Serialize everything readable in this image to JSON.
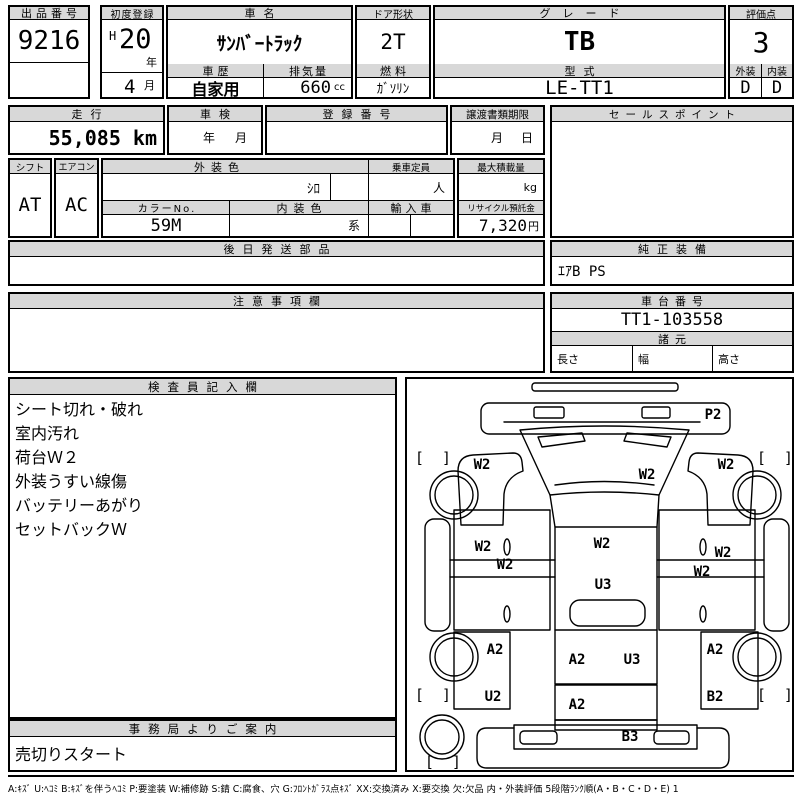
{
  "header": {
    "auction_no_label": "出品番号",
    "auction_no": "9216",
    "first_reg_label": "初度登録",
    "first_reg_era": "H",
    "first_reg_year": "20",
    "first_reg_year_unit": "年",
    "first_reg_month": "4",
    "first_reg_month_unit": "月",
    "car_name_label": "車名",
    "car_name": "ｻﾝﾊﾞｰﾄﾗｯｸ",
    "history_label": "車歴",
    "history": "自家用",
    "displacement_label": "排気量",
    "displacement": "660",
    "displacement_unit": "cc",
    "door_label": "ドア形状",
    "door": "2T",
    "fuel_label": "燃料",
    "fuel": "ｶﾞｿﾘﾝ",
    "grade_label": "グレード",
    "grade": "TB",
    "model_label": "型式",
    "model": "LE-TT1",
    "score_label": "評価点",
    "score": "3",
    "exterior_label": "外装",
    "exterior_grade": "D",
    "interior_label": "内装",
    "interior_grade": "D"
  },
  "info": {
    "mileage_label": "走行",
    "mileage": "55,085 km",
    "inspection_label": "車検",
    "inspection_year_unit": "年",
    "inspection_month_unit": "月",
    "reg_no_label": "登録番号",
    "transfer_label": "譲渡書類期限",
    "transfer_month_unit": "月",
    "transfer_day_unit": "日",
    "sales_point_label": "セールスポイント",
    "shift_label": "シフト",
    "shift": "AT",
    "aircon_label": "エアコン",
    "aircon": "AC",
    "ext_color_label": "外装色",
    "ext_color": "ｼﾛ",
    "capacity_label": "乗車定員",
    "capacity_unit": "人",
    "max_load_label": "最大積載量",
    "max_load_unit": "kg",
    "color_no_label": "カラーNo.",
    "color_no": "59M",
    "int_color_label": "内装色",
    "int_color_unit": "系",
    "import_label": "輸入車",
    "recycle_label": "リサイクル預託金",
    "recycle_fee": "7,320",
    "recycle_unit": "円",
    "parts_label": "後日発送部品",
    "equipment_label": "純正装備",
    "equipment": "ｴｱB PS",
    "caution_label": "注意事項欄",
    "chassis_label": "車台番号",
    "chassis_no": "TT1-103558",
    "specs_label": "諸元",
    "length_label": "長さ",
    "width_label": "幅",
    "height_label": "高さ"
  },
  "inspector": {
    "label": "検査員記入欄",
    "notes": [
      "シート切れ・破れ",
      "室内汚れ",
      "荷台Ｗ２",
      "外装うすい線傷",
      "バッテリーあがり",
      "セットバックＷ"
    ]
  },
  "office": {
    "label": "事務局よりご案内",
    "note": "売切りスタート"
  },
  "diagram": {
    "bracket_open": "[",
    "bracket_close": "]",
    "brackets": [
      {
        "x": 10,
        "y": 84
      },
      {
        "x": 352,
        "y": 84
      },
      {
        "x": 10,
        "y": 321
      },
      {
        "x": 352,
        "y": 321
      },
      {
        "x": 20,
        "y": 388
      }
    ],
    "marks": [
      {
        "code": "P2",
        "x": 306,
        "y": 40
      },
      {
        "code": "W2",
        "x": 75,
        "y": 90
      },
      {
        "code": "W2",
        "x": 240,
        "y": 100
      },
      {
        "code": "W2",
        "x": 319,
        "y": 90
      },
      {
        "code": "W2",
        "x": 76,
        "y": 172
      },
      {
        "code": "W2",
        "x": 98,
        "y": 190
      },
      {
        "code": "W2",
        "x": 195,
        "y": 169
      },
      {
        "code": "W2",
        "x": 316,
        "y": 178
      },
      {
        "code": "W2",
        "x": 295,
        "y": 197
      },
      {
        "code": "U3",
        "x": 196,
        "y": 210
      },
      {
        "code": "A2",
        "x": 88,
        "y": 275
      },
      {
        "code": "A2",
        "x": 170,
        "y": 285
      },
      {
        "code": "U3",
        "x": 225,
        "y": 285
      },
      {
        "code": "A2",
        "x": 308,
        "y": 275
      },
      {
        "code": "U2",
        "x": 86,
        "y": 322
      },
      {
        "code": "A2",
        "x": 170,
        "y": 330
      },
      {
        "code": "B2",
        "x": 308,
        "y": 322
      },
      {
        "code": "B3",
        "x": 223,
        "y": 362
      }
    ]
  },
  "legend": "A:ｷｽﾞ U:ﾍｺﾐ B:ｷｽﾞを伴うﾍｺﾐ P:要塗装 W:補修跡 S:錆 C:腐食、穴 G:ﾌﾛﾝﾄｶﾞﾗｽ点ｷｽﾞ XX:交換済み X:要交換 欠:欠品 内・外装評価 5段階ﾗﾝｸ順(A・B・C・D・E) 1"
}
